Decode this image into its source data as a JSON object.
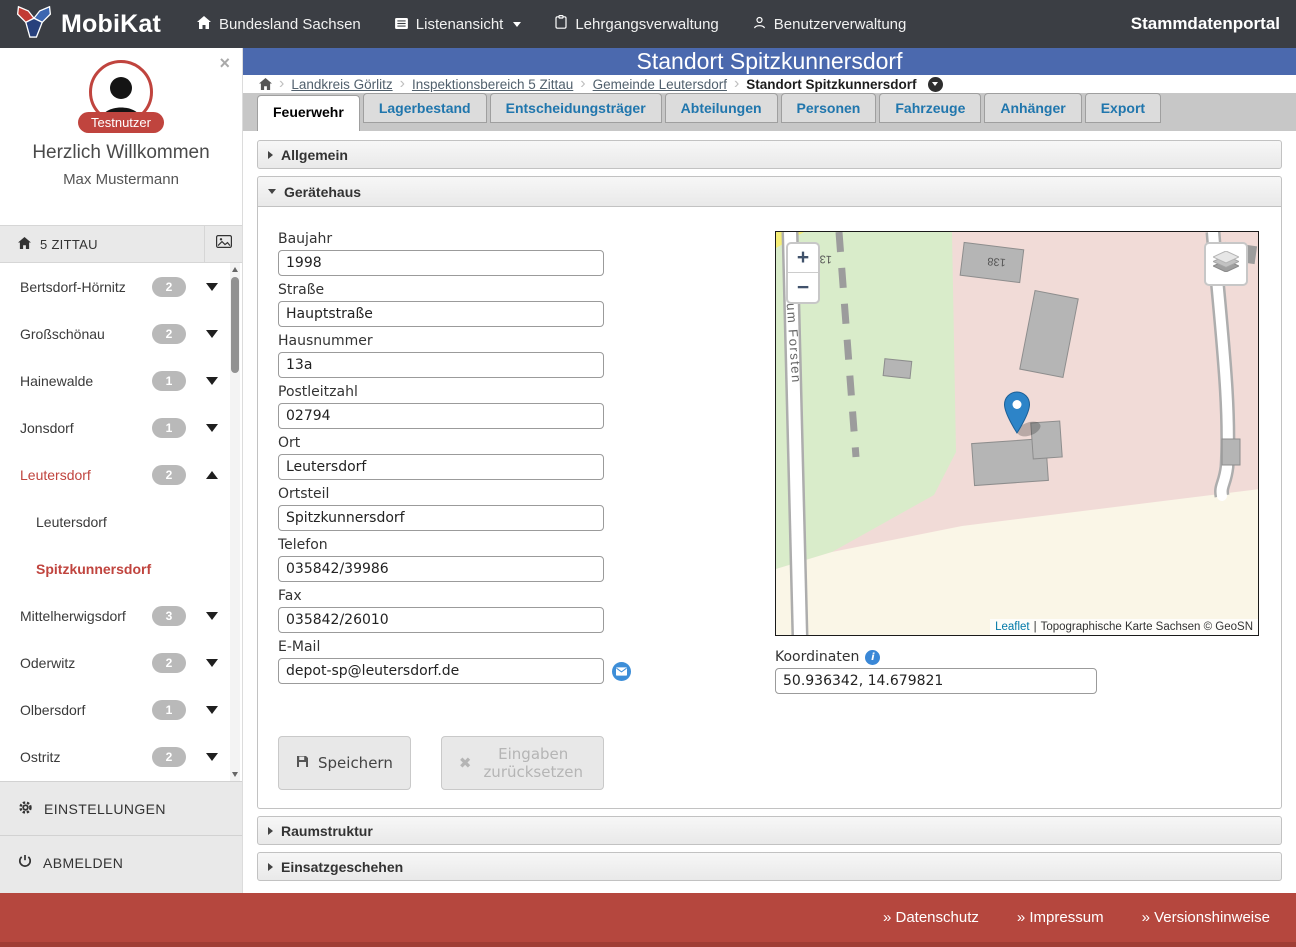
{
  "navbar": {
    "brand": "MobiKat",
    "item_region": "Bundesland Sachsen",
    "item_listview": "Listenansicht",
    "item_courses": "Lehrgangsverwaltung",
    "item_users": "Benutzerverwaltung",
    "portal": "Stammdatenportal"
  },
  "page_title": "Standort Spitzkunnersdorf",
  "breadcrumb": {
    "separator": "›",
    "links": [
      "Landkreis Görlitz",
      "Inspektionsbereich 5 Zittau",
      "Gemeinde Leutersdorf"
    ],
    "current": "Standort Spitzkunnersdorf"
  },
  "tabs": [
    {
      "label": "Feuerwehr",
      "active": true
    },
    {
      "label": "Lagerbestand"
    },
    {
      "label": "Entscheidungsträger"
    },
    {
      "label": "Abteilungen"
    },
    {
      "label": "Personen"
    },
    {
      "label": "Fahrzeuge"
    },
    {
      "label": "Anhänger"
    },
    {
      "label": "Export"
    }
  ],
  "sidebar": {
    "close": "×",
    "avatar_label": "Testnutzer",
    "welcome": "Herzlich Willkommen",
    "user": "Max Mustermann",
    "region": "5 ZITTAU",
    "list": [
      {
        "label": "Bertsdorf-Hörnitz",
        "count": "2",
        "caret": true
      },
      {
        "label": "Großschönau",
        "count": "2",
        "caret": true
      },
      {
        "label": "Hainewalde",
        "count": "1",
        "caret": true
      },
      {
        "label": "Jonsdorf",
        "count": "1",
        "caret": true
      },
      {
        "label": "Leutersdorf",
        "count": "2",
        "caret": true,
        "expanded": true,
        "active": true
      },
      {
        "label": "Leutersdorf",
        "sub": true
      },
      {
        "label": "Spitzkunnersdorf",
        "sub": true,
        "active": true
      },
      {
        "label": "Mittelherwigsdorf",
        "count": "3",
        "caret": true
      },
      {
        "label": "Oderwitz",
        "count": "2",
        "caret": true
      },
      {
        "label": "Olbersdorf",
        "count": "1",
        "caret": true
      },
      {
        "label": "Ostritz",
        "count": "2",
        "caret": true
      }
    ],
    "settings": "EINSTELLUNGEN",
    "logout": "ABMELDEN"
  },
  "sections": {
    "allgemein": "Allgemein",
    "geraetehaus": "Gerätehaus",
    "raumstruktur": "Raumstruktur",
    "einsatzgeschehen": "Einsatzgeschehen"
  },
  "form": {
    "fields": [
      {
        "label": "Baujahr",
        "value": "1998"
      },
      {
        "label": "Straße",
        "value": "Hauptstraße"
      },
      {
        "label": "Hausnummer",
        "value": "13a"
      },
      {
        "label": "Postleitzahl",
        "value": "02794"
      },
      {
        "label": "Ort",
        "value": "Leutersdorf"
      },
      {
        "label": "Ortsteil",
        "value": "Spitzkunnersdorf"
      },
      {
        "label": "Telefon",
        "value": "035842/39986"
      },
      {
        "label": "Fax",
        "value": "035842/26010"
      },
      {
        "label": "E-Mail",
        "value": "depot-sp@leutersdorf.de",
        "email_action": true
      }
    ],
    "save": "Speichern",
    "reset": "Eingaben zurücksetzen",
    "coordinates_label": "Koordinaten",
    "coordinates_value": "50.936342, 14.679821"
  },
  "map": {
    "zoom_in": "+",
    "zoom_out": "−",
    "street": "Zum Forsten",
    "labels": [
      "134",
      "138"
    ],
    "attribution_link": "Leaflet",
    "attribution_sep": "|",
    "attribution_text": "Topographische Karte Sachsen © GeoSN"
  },
  "footer": {
    "links": [
      "» Datenschutz",
      "» Impressum",
      "» Versionshinweise"
    ]
  },
  "colors": {
    "navbar_bg": "#3b3e44",
    "title_bg": "#4b69ae",
    "brand_red": "#c0443e",
    "footer_red": "#b5473e",
    "tab_link_blue": "#2076ad",
    "marker_blue": "#2d84c8"
  }
}
